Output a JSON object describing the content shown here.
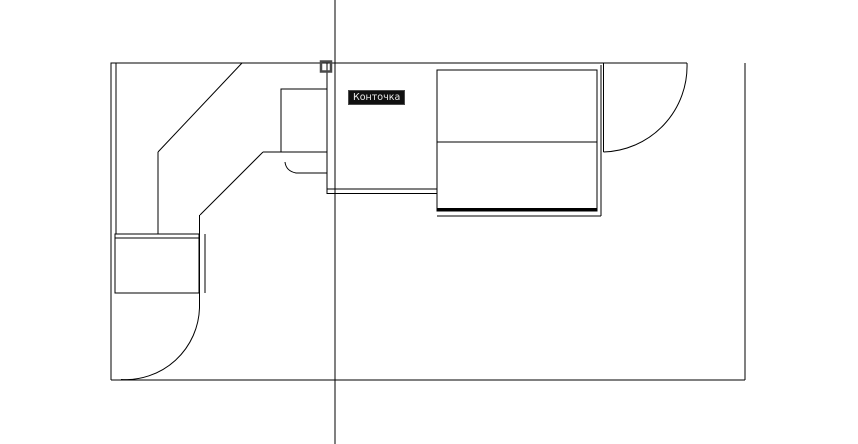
{
  "canvas": {
    "background": "#ffffff",
    "line_color": "#000000"
  },
  "snap": {
    "tooltip_label": "Конточка",
    "tooltip_bg": "#101010",
    "tooltip_text_color": "#ededed",
    "tooltip_border": "#4b4b4b",
    "marker_shape": "endpoint-square",
    "marker_color": "#4a4a4a"
  }
}
